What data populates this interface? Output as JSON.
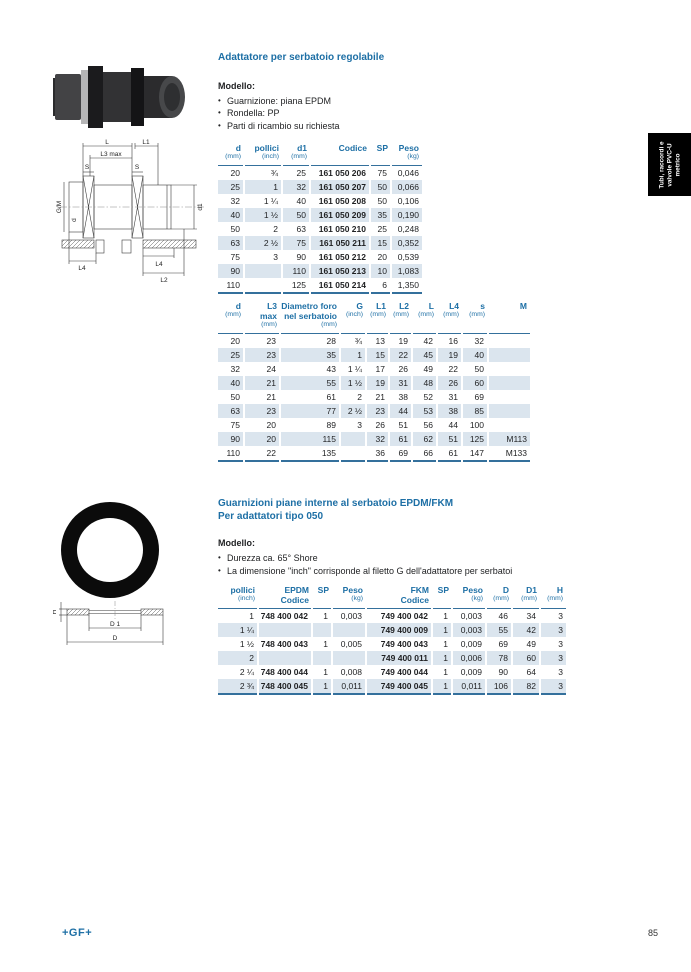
{
  "page": {
    "brand": "+GF+",
    "page_number": "85"
  },
  "side_tab": {
    "lines": [
      "Tubi, raccordi e",
      "valvole PVC-U",
      "metrico"
    ]
  },
  "section1": {
    "title": "Adattatore per serbatoio regolabile",
    "model_label": "Modello:",
    "bullets": [
      "Guarnizione: piana EPDM",
      "Rondella: PP",
      "Parti di ricambio su richiesta"
    ],
    "table1": {
      "headers": [
        {
          "label": "d",
          "sub": "(mm)"
        },
        {
          "label": "pollici",
          "sub": "(inch)"
        },
        {
          "label": "d1",
          "sub": "(mm)"
        },
        {
          "label": "Codice"
        },
        {
          "label": "SP"
        },
        {
          "label": "Peso",
          "sub": "(kg)"
        }
      ],
      "bold_cols": [
        3
      ],
      "rows": [
        [
          "20",
          "¾",
          "25",
          "161 050 206",
          "75",
          "0,046"
        ],
        [
          "25",
          "1",
          "32",
          "161 050 207",
          "50",
          "0,066"
        ],
        [
          "32",
          "1 ¼",
          "40",
          "161 050 208",
          "50",
          "0,106"
        ],
        [
          "40",
          "1 ½",
          "50",
          "161 050 209",
          "35",
          "0,190"
        ],
        [
          "50",
          "2",
          "63",
          "161 050 210",
          "25",
          "0,248"
        ],
        [
          "63",
          "2 ½",
          "75",
          "161 050 211",
          "15",
          "0,352"
        ],
        [
          "75",
          "3",
          "90",
          "161 050 212",
          "20",
          "0,539"
        ],
        [
          "90",
          "",
          "110",
          "161 050 213",
          "10",
          "1,083"
        ],
        [
          "110",
          "",
          "125",
          "161 050 214",
          "6",
          "1,350"
        ]
      ]
    },
    "table2": {
      "headers": [
        {
          "label": "d",
          "sub": "(mm)"
        },
        {
          "label": "L3\nmax",
          "sub": "(mm)"
        },
        {
          "label": "Diametro foro nel serbatoio",
          "sub": "(mm)"
        },
        {
          "label": "G",
          "sub": "(inch)"
        },
        {
          "label": "L1",
          "sub": "(mm)"
        },
        {
          "label": "L2",
          "sub": "(mm)"
        },
        {
          "label": "L",
          "sub": "(mm)"
        },
        {
          "label": "L4",
          "sub": "(mm)"
        },
        {
          "label": "s",
          "sub": "(mm)"
        },
        {
          "label": "M"
        }
      ],
      "bold_cols": [],
      "rows": [
        [
          "20",
          "23",
          "28",
          "¾",
          "13",
          "19",
          "42",
          "16",
          "32",
          ""
        ],
        [
          "25",
          "23",
          "35",
          "1",
          "15",
          "22",
          "45",
          "19",
          "40",
          ""
        ],
        [
          "32",
          "24",
          "43",
          "1 ¼",
          "17",
          "26",
          "49",
          "22",
          "50",
          ""
        ],
        [
          "40",
          "21",
          "55",
          "1 ½",
          "19",
          "31",
          "48",
          "26",
          "60",
          ""
        ],
        [
          "50",
          "21",
          "61",
          "2",
          "21",
          "38",
          "52",
          "31",
          "69",
          ""
        ],
        [
          "63",
          "23",
          "77",
          "2 ½",
          "23",
          "44",
          "53",
          "38",
          "85",
          ""
        ],
        [
          "75",
          "20",
          "89",
          "3",
          "26",
          "51",
          "56",
          "44",
          "100",
          ""
        ],
        [
          "90",
          "20",
          "115",
          "",
          "32",
          "61",
          "62",
          "51",
          "125",
          "M113"
        ],
        [
          "110",
          "22",
          "135",
          "",
          "36",
          "69",
          "66",
          "61",
          "147",
          "M133"
        ]
      ]
    }
  },
  "section2": {
    "title_line1": "Guarnizioni piane interne al serbatoio EPDM/FKM",
    "title_line2": "Per adattatori tipo 050",
    "model_label": "Modello:",
    "bullets": [
      "Durezza ca. 65° Shore",
      "La dimensione \"inch\" corrisponde al filetto G dell'adattatore per serbatoi"
    ],
    "table3": {
      "headers": [
        {
          "label": "pollici",
          "sub": "(inch)"
        },
        {
          "label": "EPDM",
          "sub": "Codice",
          "sub_bold": true
        },
        {
          "label": "SP"
        },
        {
          "label": "Peso",
          "sub": "(kg)"
        },
        {
          "label": "FKM",
          "sub": "Codice",
          "sub_bold": true
        },
        {
          "label": "SP"
        },
        {
          "label": "Peso",
          "sub": "(kg)"
        },
        {
          "label": "D",
          "sub": "(mm)"
        },
        {
          "label": "D1",
          "sub": "(mm)"
        },
        {
          "label": "H",
          "sub": "(mm)"
        }
      ],
      "bold_cols": [
        1,
        4
      ],
      "rows": [
        [
          "1",
          "748 400 042",
          "1",
          "0,003",
          "749 400 042",
          "1",
          "0,003",
          "46",
          "34",
          "3"
        ],
        [
          "1 ¼",
          "",
          "",
          "",
          "749 400 009",
          "1",
          "0,003",
          "55",
          "42",
          "3"
        ],
        [
          "1 ½",
          "748 400 043",
          "1",
          "0,005",
          "749 400 043",
          "1",
          "0,009",
          "69",
          "49",
          "3"
        ],
        [
          "2",
          "",
          "",
          "",
          "749 400 011",
          "1",
          "0,006",
          "78",
          "60",
          "3"
        ],
        [
          "2 ¼",
          "748 400 044",
          "1",
          "0,008",
          "749 400 044",
          "1",
          "0,009",
          "90",
          "64",
          "3"
        ],
        [
          "2 ¾",
          "748 400 045",
          "1",
          "0,011",
          "749 400 045",
          "1",
          "0,011",
          "106",
          "82",
          "3"
        ]
      ]
    }
  },
  "drawing1": {
    "labels": {
      "L": "L",
      "L1": "L1",
      "L3": "L3 max",
      "S1": "S",
      "S2": "S",
      "GM": "G/M",
      "d": "d",
      "d1": "d1",
      "L4a": "L4",
      "L4b": "L4",
      "L2": "L2"
    }
  },
  "drawing2": {
    "labels": {
      "H": "H",
      "D1": "D 1",
      "D": "D"
    }
  },
  "colors": {
    "accent_blue": "#1d6fa5",
    "rule_blue": "#34709c",
    "row_stripe": "#dbe5ee"
  }
}
